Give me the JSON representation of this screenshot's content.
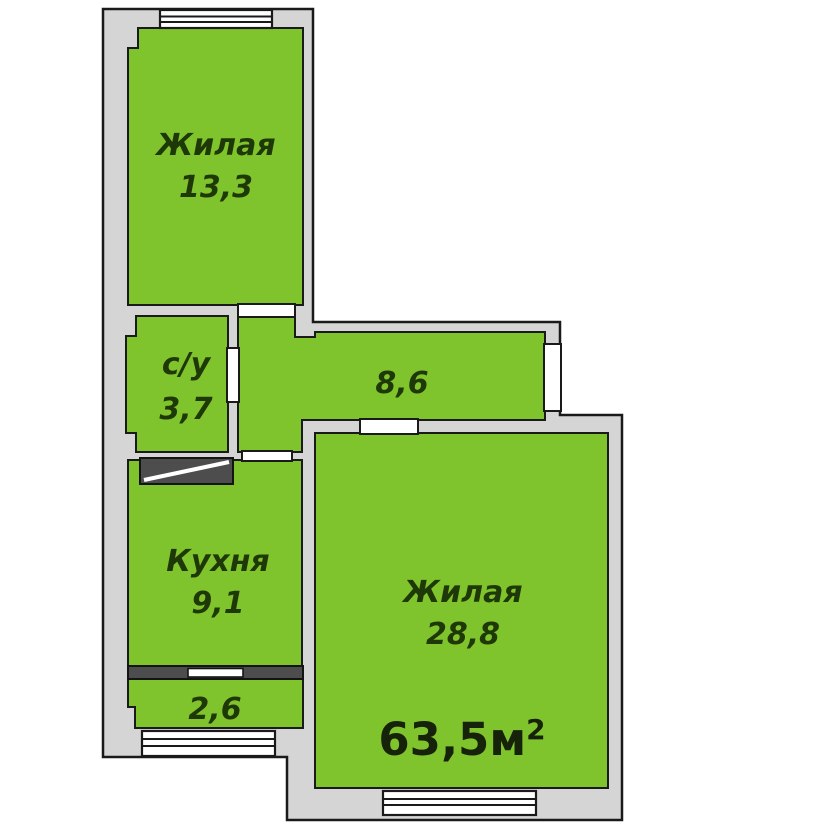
{
  "plan": {
    "type": "apartment-floor-plan",
    "colors": {
      "room_fill": "#7fc42c",
      "wall_fill": "#d5d5d5",
      "outline": "#1a1a1a",
      "shaft_fill": "#4d4d4d",
      "label_color": "#1f3807",
      "total_color": "#16230a"
    },
    "rooms": {
      "living1": {
        "name": "Жилая",
        "area": "13,3"
      },
      "bathroom": {
        "name": "с/у",
        "area": "3,7"
      },
      "hall": {
        "area": "8,6"
      },
      "kitchen": {
        "name": "Кухня",
        "area": "9,1"
      },
      "living2": {
        "name": "Жилая",
        "area": "28,8"
      },
      "balcony": {
        "area": "2,6"
      }
    },
    "total_area": {
      "value": "63,5м",
      "sup": "2"
    }
  }
}
